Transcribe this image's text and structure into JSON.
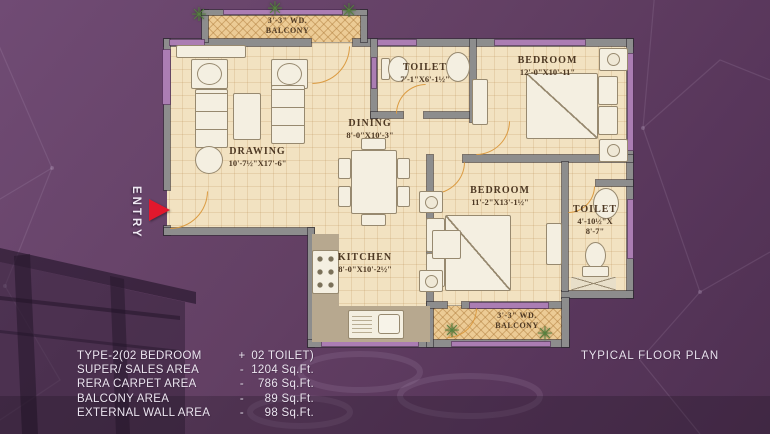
{
  "plan_title": "TYPICAL FLOOR PLAN",
  "entry": {
    "label": "ENTRY"
  },
  "icons": {
    "plant": "✳"
  },
  "rooms": {
    "balcony_top": {
      "line1": "3'-3\" WD.",
      "line2": "BALCONY"
    },
    "drawing": {
      "name": "DRAWING",
      "dim": "10'-7½\"X17'-6\""
    },
    "dining": {
      "name": "DINING",
      "dim": "8'-0\"X10'-3\""
    },
    "toilet1": {
      "name": "TOILET",
      "dim": "7'-1\"X6'-1½\""
    },
    "bedroom1": {
      "name": "BEDROOM",
      "dim": "12'-0\"X10'-11\""
    },
    "bedroom2": {
      "name": "BEDROOM",
      "dim": "11'-2\"X13'-1½\""
    },
    "toilet2": {
      "name": "TOILET",
      "dim1": "4'-10½\"X",
      "dim2": "8'-7\""
    },
    "kitchen": {
      "name": "KITCHEN",
      "dim": "8'-0\"X10'-2½\""
    },
    "balcony_bottom": {
      "line1": "3'-3\" WD.",
      "line2": "BALCONY"
    }
  },
  "info": {
    "rows": [
      {
        "label": "TYPE-2(02 BEDROOM",
        "sep": "+",
        "value": "02 TOILET)"
      },
      {
        "label": "SUPER/ SALES AREA",
        "sep": "-",
        "value": "1204 Sq.Ft."
      },
      {
        "label": "RERA CARPET AREA",
        "sep": "-",
        "value": "786 Sq.Ft."
      },
      {
        "label": "BALCONY AREA",
        "sep": "-",
        "value": "89 Sq.Ft."
      },
      {
        "label": "EXTERNAL WALL AREA",
        "sep": "-",
        "value": "98 Sq.Ft."
      }
    ]
  },
  "colors": {
    "background": "#5f3d63",
    "floor": "#f2e2c1",
    "balcony_floor": "#eccb95",
    "wall": "#8d8d8d",
    "window_accent": "#ab7db3",
    "door": "#db9b42",
    "entry_arrow": "#e2182d",
    "info_text": "#ece5f0",
    "label_text": "#4d3823"
  }
}
